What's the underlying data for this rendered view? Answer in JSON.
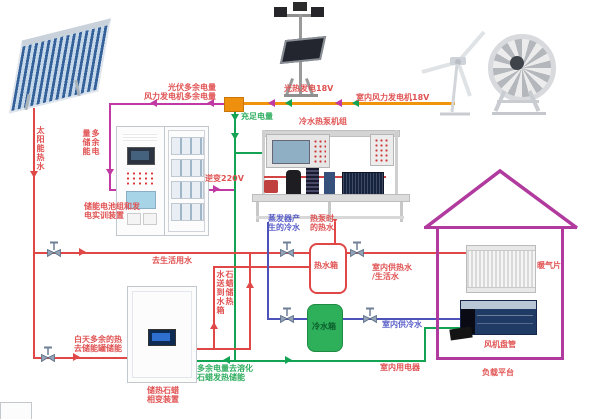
{
  "labels": {
    "pv_excess": "光伏多余电量",
    "wind_excess": "风力发电机多余电量",
    "enough_power": "充足电量",
    "solar_gen": "光热发电18V",
    "indoor_wind_gen": "室内风力发电机18V",
    "heat_pump_unit": "冷水热泵机组",
    "excess_store": "多余电量储能",
    "battery_l1": "储能电池组和发",
    "battery_l2": "电实训装置",
    "inverter": "逆变220V",
    "evap_l1": "蒸发器产",
    "evap_l2": "生的冷水",
    "hp_hot_l1": "热泵时",
    "hp_hot_l2": "的热水",
    "hot_tank": "热水箱",
    "cold_tank": "冷水箱",
    "indoor_hot_l1": "室内供热水",
    "indoor_hot_l2": "/生活水",
    "indoor_cold": "室内供冷水",
    "indoor_elec": "室内用电器",
    "to_domestic": "去生活用水",
    "day_heat_l1": "白天多余的热",
    "day_heat_l2": "去储能罐储能",
    "melt_l1": "多余电量去溶化",
    "melt_l2": "石蜡发热储能",
    "paraffin_col_r": "石蜡储热",
    "paraffin_col_l": "水送到水箱",
    "solar_water": "太阳能热水",
    "paraffin_dev_l1": "储热石蜡",
    "paraffin_dev_l2": "相变装置",
    "radiator": "暖气片",
    "fan_coil": "风机盘管",
    "load_platform": "负载平台"
  },
  "colors": {
    "red_pipe": "#e04848",
    "blue_pipe": "#4d52bb",
    "green_wire": "#12a452",
    "magenta_wire": "#c13aa3",
    "orange_bus": "#f0940c",
    "house_outline": "#b13a9e",
    "label_red": "#e05252",
    "label_green": "#2fae5f",
    "label_blue": "#5a5fc8",
    "cold_tank_fill": "#2eb05a"
  }
}
